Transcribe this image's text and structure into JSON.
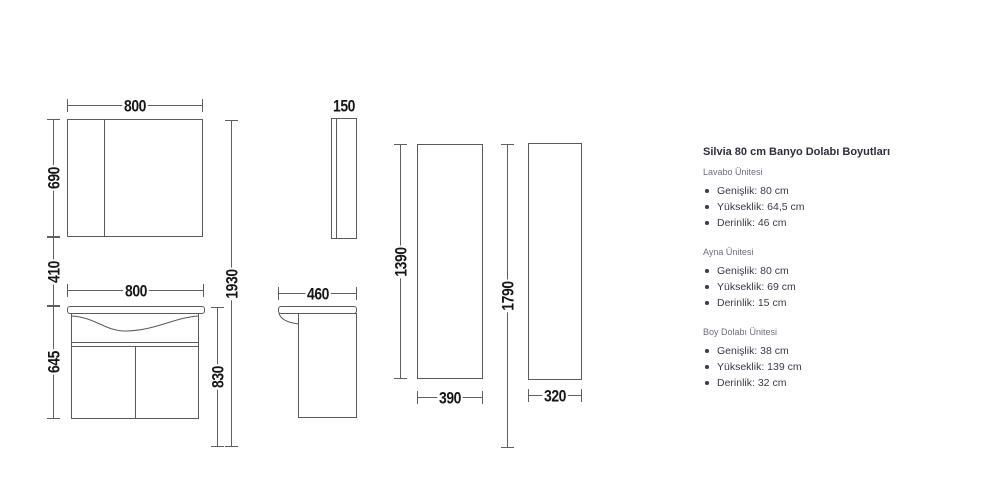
{
  "colors": {
    "background": "#ffffff",
    "drawing_line": "#5a5a5a",
    "dim_text": "#161616",
    "title_text": "#2d2d3d",
    "section_label_text": "#6e6e78",
    "item_text": "#3a3a47"
  },
  "diagram": {
    "front_view": {
      "mirror_width": "800",
      "mirror_height": "690",
      "wall_gap": "410",
      "vanity_width": "800",
      "vanity_height": "645",
      "total_height": "1930",
      "vanity_top_height": "830"
    },
    "side_view": {
      "mirror_depth": "150",
      "vanity_depth": "460"
    },
    "tall_cabinet": {
      "height": "1390",
      "width": "390",
      "top_height": "1790",
      "depth": "320"
    }
  },
  "specs": {
    "title": "Silvia 80 cm Banyo Dolabı Boyutları",
    "sections": [
      {
        "label": "Lavabo Ünitesi",
        "items": [
          "Genişlik: 80 cm",
          "Yükseklik: 64,5 cm",
          "Derinlik: 46 cm"
        ]
      },
      {
        "label": "Ayna Ünitesi",
        "items": [
          "Genişlik: 80 cm",
          "Yükseklik: 69 cm",
          "Derinlik: 15 cm"
        ]
      },
      {
        "label": "Boy Dolabı Ünitesi",
        "items": [
          "Genişlik: 38 cm",
          "Yükseklik: 139 cm",
          "Derinlik: 32 cm"
        ]
      }
    ]
  }
}
